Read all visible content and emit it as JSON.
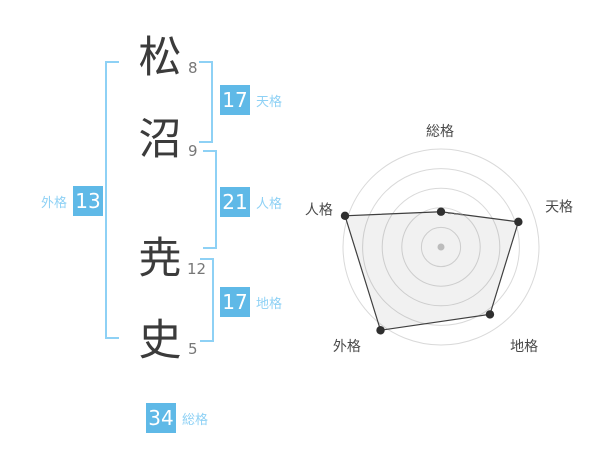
{
  "colors": {
    "background": "#ffffff",
    "badge_bg": "#5fb9e7",
    "badge_text": "#ffffff",
    "bracket": "#8ed1f5",
    "badge_label": "#8ed1f5",
    "kanji": "#3b3b3b",
    "stroke_count": "#777777"
  },
  "name": {
    "characters": [
      {
        "char": "松",
        "strokes": "8"
      },
      {
        "char": "沼",
        "strokes": "9"
      },
      {
        "char": "尭",
        "strokes": "12"
      },
      {
        "char": "史",
        "strokes": "5"
      }
    ]
  },
  "gokaku": {
    "tenkaku": {
      "value": "17",
      "label": "天格"
    },
    "jinkaku": {
      "value": "21",
      "label": "人格"
    },
    "chikaku": {
      "value": "17",
      "label": "地格"
    },
    "gaikaku": {
      "value": "13",
      "label": "外格"
    },
    "soukaku": {
      "value": "34",
      "label": "総格"
    }
  },
  "chart_data": {
    "type": "radar",
    "axes": [
      "総格",
      "天格",
      "地格",
      "外格",
      "人格"
    ],
    "values": [
      36,
      83,
      85,
      105,
      103
    ],
    "scale": {
      "min": 0,
      "max": 100,
      "ring_step": 20,
      "rings": [
        20,
        40,
        60,
        80,
        100
      ]
    },
    "start_angle_deg": 90,
    "direction": "clockwise",
    "grid": "concentric-circles",
    "legend": "none",
    "colors": {
      "grid": "#d9d9d9",
      "polygon_fill": "rgba(0,0,0,0.055)",
      "polygon_stroke": "#3f3f3f",
      "point": "#2f2f2f",
      "center_dot": "#bcbcbc",
      "axis_label": "#4a4a4a"
    }
  }
}
